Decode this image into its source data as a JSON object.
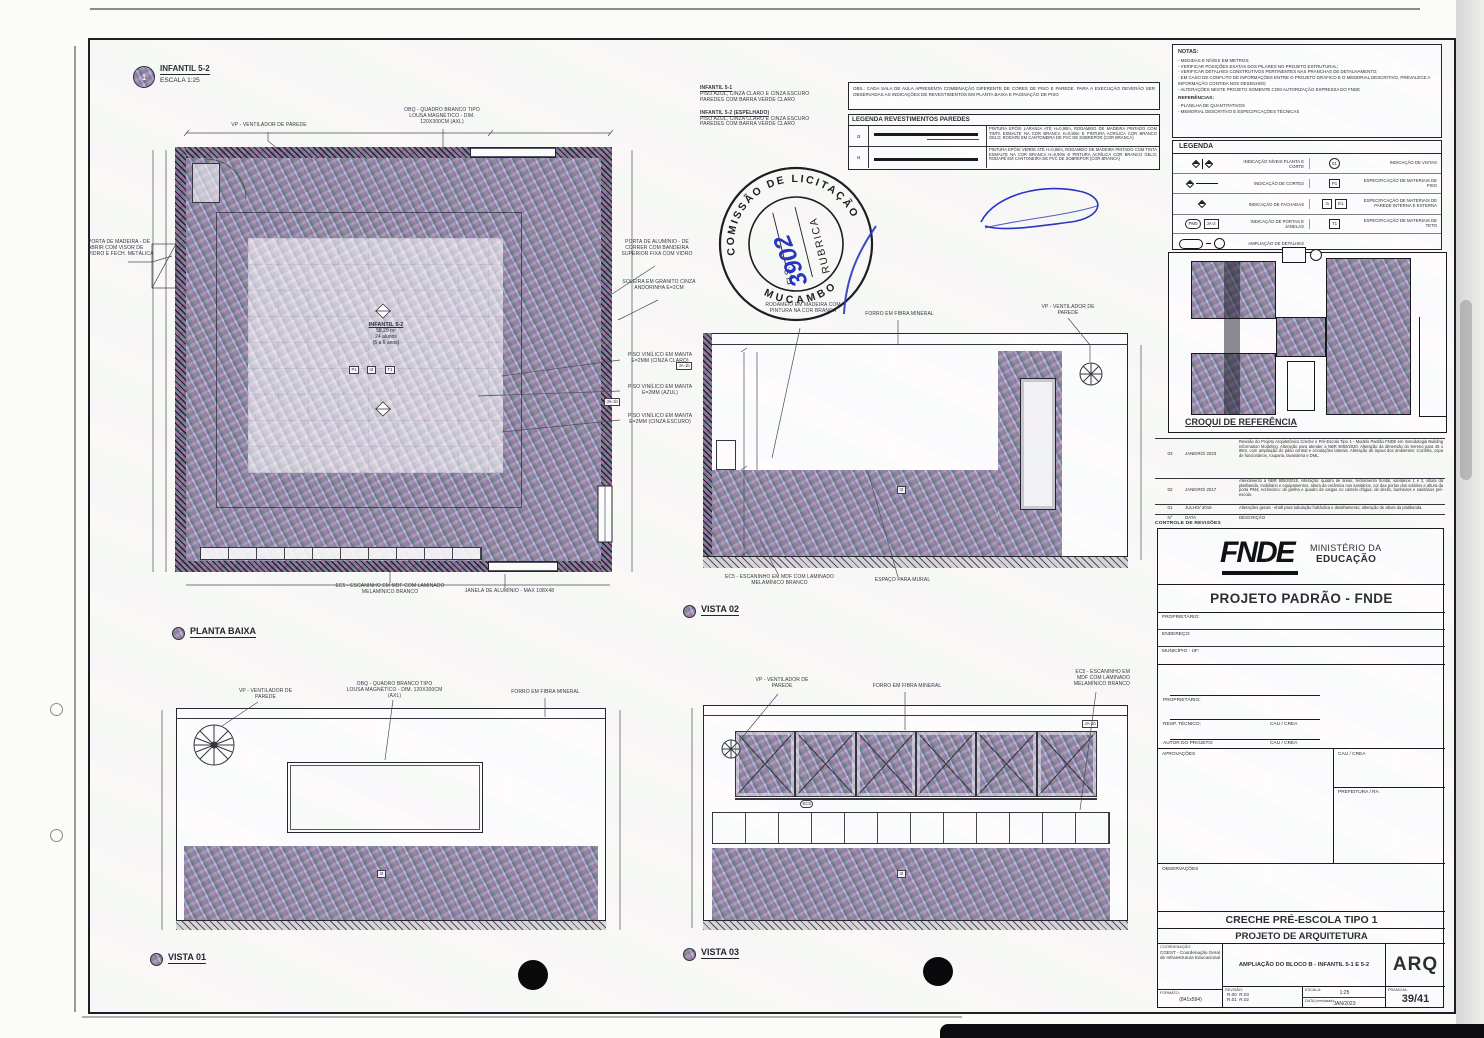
{
  "callouts": {
    "plan_ref_num": "1",
    "plan_ref_title": "INFANTIL 5-2",
    "plan_ref_scale": "ESCALA 1:25",
    "planta_baixa": "PLANTA BAIXA",
    "vista_01": "VISTA 01",
    "vista_02": "VISTA 02",
    "vista_03": "VISTA 03"
  },
  "room": {
    "name": "INFANTIL 5-2",
    "area": "58,29 m²",
    "capacity": "24 alunos",
    "ages": "(5 a 6 anos)"
  },
  "finish_note": {
    "b1_title": "INFANTIL 5-1",
    "b1_l1": "PISO AZUL, CINZA CLARO E CINZA ESCURO",
    "b1_l2": "PAREDES COM BARRA VERDE CLARO",
    "b2_title": "INFANTIL 5-2 (espelhado)",
    "b2_l1": "PISO AZUL, CINZA CLARO E CINZA ESCURO",
    "b2_l2": "PAREDES COM BARRA VERDE CLARO"
  },
  "obs": "OBS.: CADA SALA DE AULA APRESENTA COMBINAÇÃO DIFERENTE DE CORES DE PISO E PAREDE. PARA A EXECUÇÃO DEVERÃO SER OBSERVADAS AS INDICAÇÕES DE REVESTIMENTOS EM PLANTA BAIXA E PAGINAÇÃO DE PISO",
  "leg_rev": {
    "title": "LEGENDA REVESTIMENTOS PAREDES",
    "r1_code": "I3",
    "r1_desc": "PINTURA EPÓXI LARANJA ATÉ H=0,90m, RODAMEIO DE MADEIRA PINTADO COM TINTA ESMALTE NA COR BRANCA H=0,90m E PINTURA ACRÍLICA COR BRANCO GELO; RODAPÉ EM CANTONEIRA DE PVC DE SOBREPOR (COR BRANCA)",
    "r2_code": "I4",
    "r2_desc": "PINTURA EPÓXI VERDE ATÉ H=0,90m, RODAMEIO DE MADEIRA PINTADO COM TINTA ESMALTE NA COR BRANCA H=0,90m E PINTURA ACRÍLICA COR BRANCO GELO; RODAPÉ EM CANTONEIRA DE PVC DE SOBREPOR (COR BRANCA)"
  },
  "plan_ann": {
    "vp": "VP - VENTILADOR DE PAREDE",
    "obq1": "OBQ - QUADRO BRANCO TIPO",
    "obq2": "LOUSA MAGNÉTICO - DIM.",
    "obq3": "120x300cm (AxL)",
    "porta_mad": "PORTA DE MADEIRA - DE ABRIR COM VISOR DE VIDRO E FECH. METÁLICA",
    "porta_alu": "PORTA DE ALUMÍNIO - DE CORRER COM BANDEIRA SUPERIOR FIXA COM VIDRO",
    "soleira": "SOLEIRA EM GRANITO CINZA ANDORINHA E=2cm",
    "piso_claro": "PISO VINÍLICO EM MANTA E=2mm (cinza claro)",
    "piso_azul": "PISO VINÍLICO EM MANTA E=2mm (azul)",
    "piso_escuro": "PISO VINÍLICO EM MANTA E=2mm (cinza escuro)",
    "ec5": "EC5 - ESCANINHO EM MDF COM LAMINADO MELAMÍNICO BRANCO",
    "janela": "JANELA DE ALUMÍNIO - MAX 108x48",
    "tag_p": "P1",
    "tag_i": "I3",
    "tag_t": "T1",
    "tag_ja": "JA-1b"
  },
  "v02": {
    "rodameio": "RODAMEIO EM MADEIRA COM PINTURA NA COR BRANCA",
    "forro": "FORRO EM FIBRA MINERAL",
    "vp": "VP - VENTILADOR DE PAREDE",
    "ec5": "EC5 - ESCANINHO EM MDF COM LAMINADO MELAMÍNICO BRANCO",
    "mural": "ESPAÇO PARA MURAL",
    "tag_i": "I3"
  },
  "v01": {
    "vp": "VP - VENTILADOR DE PAREDE",
    "obq1": "OBQ - QUADRO BRANCO TIPO",
    "obq2": "LOUSA MAGNÉTICO - DIM. 120x300cm (AxL)",
    "forro": "FORRO EM FIBRA MINERAL",
    "tag_i": "I3"
  },
  "v03": {
    "vp": "VP - VENTILADOR DE PAREDE",
    "forro": "FORRO EM FIBRA MINERAL",
    "ec51": "EC5 - ESCANINHO EM",
    "ec52": "MDF COM LAMINADO",
    "ec53": "MELAMÍNICO BRANCO",
    "tag_ec": "EC5",
    "tag_i": "I3",
    "tag_ja": "JA-1b"
  },
  "stamp": {
    "ring_top": "COMISSÃO DE LICITAÇÃO",
    "ring_side": "MUCAMBO",
    "fls": "FLS.",
    "fls_value": "3902",
    "rubrica": "RUBRICA",
    "ink": "#2a36c0"
  },
  "notas": {
    "title": "NOTAS:",
    "i0": "- MEDIDAS E NÍVEIS EM METROS;",
    "i1": "- VERIFICAR POSIÇÕES EXATAS DOS PILARES NO PROJETO ESTRUTURAL;",
    "i2": "- VERIFICAR DETALHES CONSTRUTIVOS PERTINENTES NAS PRANCHAS DE DETALHAMENTO;",
    "i3": "- EM CASO DE CONFLITO DE INFORMAÇÕES ENTRE O PROJETO GRÁFICO E O MEMORIAL DESCRITIVO, PREVALECE A INFORMAÇÃO CONTIDA NOS DESENHOS;",
    "i4": "- ALTERAÇÕES NESTE PROJETO SOMENTE COM AUTORIZAÇÃO EXPRESSA DO FNDE",
    "ref_title": "REFERÊNCIAS:",
    "r0": "- PLANILHA DE QUANTITATIVOS",
    "r1": "- MEMORIAL DESCRITIVO E ESPECIFICAÇÕES TÉCNICAS"
  },
  "legenda": {
    "title": "LEGENDA",
    "l1": "INDICAÇÃO NÍVEIS PLANTA E CORTE",
    "s1": "01",
    "r1": "INDICAÇÃO DE VISTAS",
    "l2": "INDICAÇÃO DE CORTES",
    "s2": "P1",
    "r2": "ESPECIFICAÇÃO DE MATERIAIS DE PISO",
    "l3": "INDICAÇÃO DE FACHADAS",
    "s3a": "I1",
    "s3b": "E1",
    "r3": "ESPECIFICAÇÃO DE MATERIAIS DE PAREDE INTERNA E EXTERNA",
    "l4": "INDICAÇÃO DE PORTAS E JANELAS",
    "sym4a": "PM0",
    "sym4b": "JA-2",
    "s4": "T1",
    "r4": "ESPECIFICAÇÃO DE MATERIAIS DE TETO",
    "l5": "AMPLIAÇÃO DE DETALHES"
  },
  "croqui": {
    "title": "CROQUI DE REFERÊNCIA"
  },
  "rev": {
    "title": "CONTROLE DE REVISÕES",
    "h_num": "N°",
    "h_date": "DATA",
    "h_desc": "DESCRIÇÃO",
    "r3_num": "03",
    "r3_date": "JANEIRO/ 2023",
    "r3_desc": "Revisão do Projeto Arquitetônico Creche e Pré-Escola Tipo 1 - Modelo Padrão FNDE em metodologia Building Information Modeling. Alteração para atender a NBR 9050/2020. Alteração da dimensão do terreno para 45 x 85m, com ampliação do pátio central e circulações laterais. Alteração de layout dos ambientes: Cozinha, copa de funcionários, rouparia, lavanderia e DML.",
    "r2_num": "02",
    "r2_date": "JANEIRO/ 2017",
    "r2_desc": "Atendimento à NBR 9050/2015. Alteração: quadro de áreas, fechamento frontal, sanitários 1 e 2, altura da platibanda, mobiliário e equipamentos, altura da cerâmica nos sanitários, cor das portas dos solários e altura da porta PM4; Acréscimo: de grelha e quadro de cargas no castelo d'água, de decks, banheiros e sanitários pré-escola.",
    "r1_num": "01",
    "r1_date": "JULHO/ 2016",
    "r1_desc": "Alterações gerais - shaft para tubulação hidráulica e detalhamento; alteração de altura da platibanda."
  },
  "tb": {
    "logo": "FNDE",
    "min1": "MINISTÉRIO DA",
    "min2": "EDUCAÇÃO",
    "padrao": "PROJETO PADRÃO - FNDE",
    "proprietario": "PROPRIETÁRIO:",
    "endereco": "ENDEREÇO:",
    "municipio": "MUNICÍPIO - UF:",
    "proprietario2": "PROPRIETÁRIO:",
    "resp": "RESP. TÉCNICO:",
    "autor": "AUTOR DO PROJETO:",
    "cau1": "CAU / CREA",
    "cau2": "CAU / CREA",
    "cau3": "CAU / CREA",
    "aprov": "APROVAÇÕES",
    "pref": "PREFEITURA / RA",
    "obs": "OBSERVAÇÕES",
    "creche": "CRECHE PRÉ-ESCOLA TIPO 1",
    "projarq": "PROJETO DE ARQUITETURA",
    "coord_label": "COORDENAÇÃO:",
    "coord": "CGEST - Coordenação Geral de Infraestrutura Educacional",
    "subject": "AMPLIAÇÃO DO BLOCO B - INFANTIL 5-1 E 5-2",
    "arq": "ARQ",
    "rev_label": "REVISÃO:",
    "rev_a": "R.00",
    "rev_b": "R.01",
    "rev_c": "R.02",
    "rev_d": "R.03",
    "escala_label": "ESCALA:",
    "escala": "1:25",
    "data_label": "DATA (mm/aaaa):",
    "data": "JAN/2023",
    "formato_label": "FORMATO:",
    "formato": "(841x594)",
    "prancha_label": "PRANCHA:",
    "prancha": "39/41"
  }
}
